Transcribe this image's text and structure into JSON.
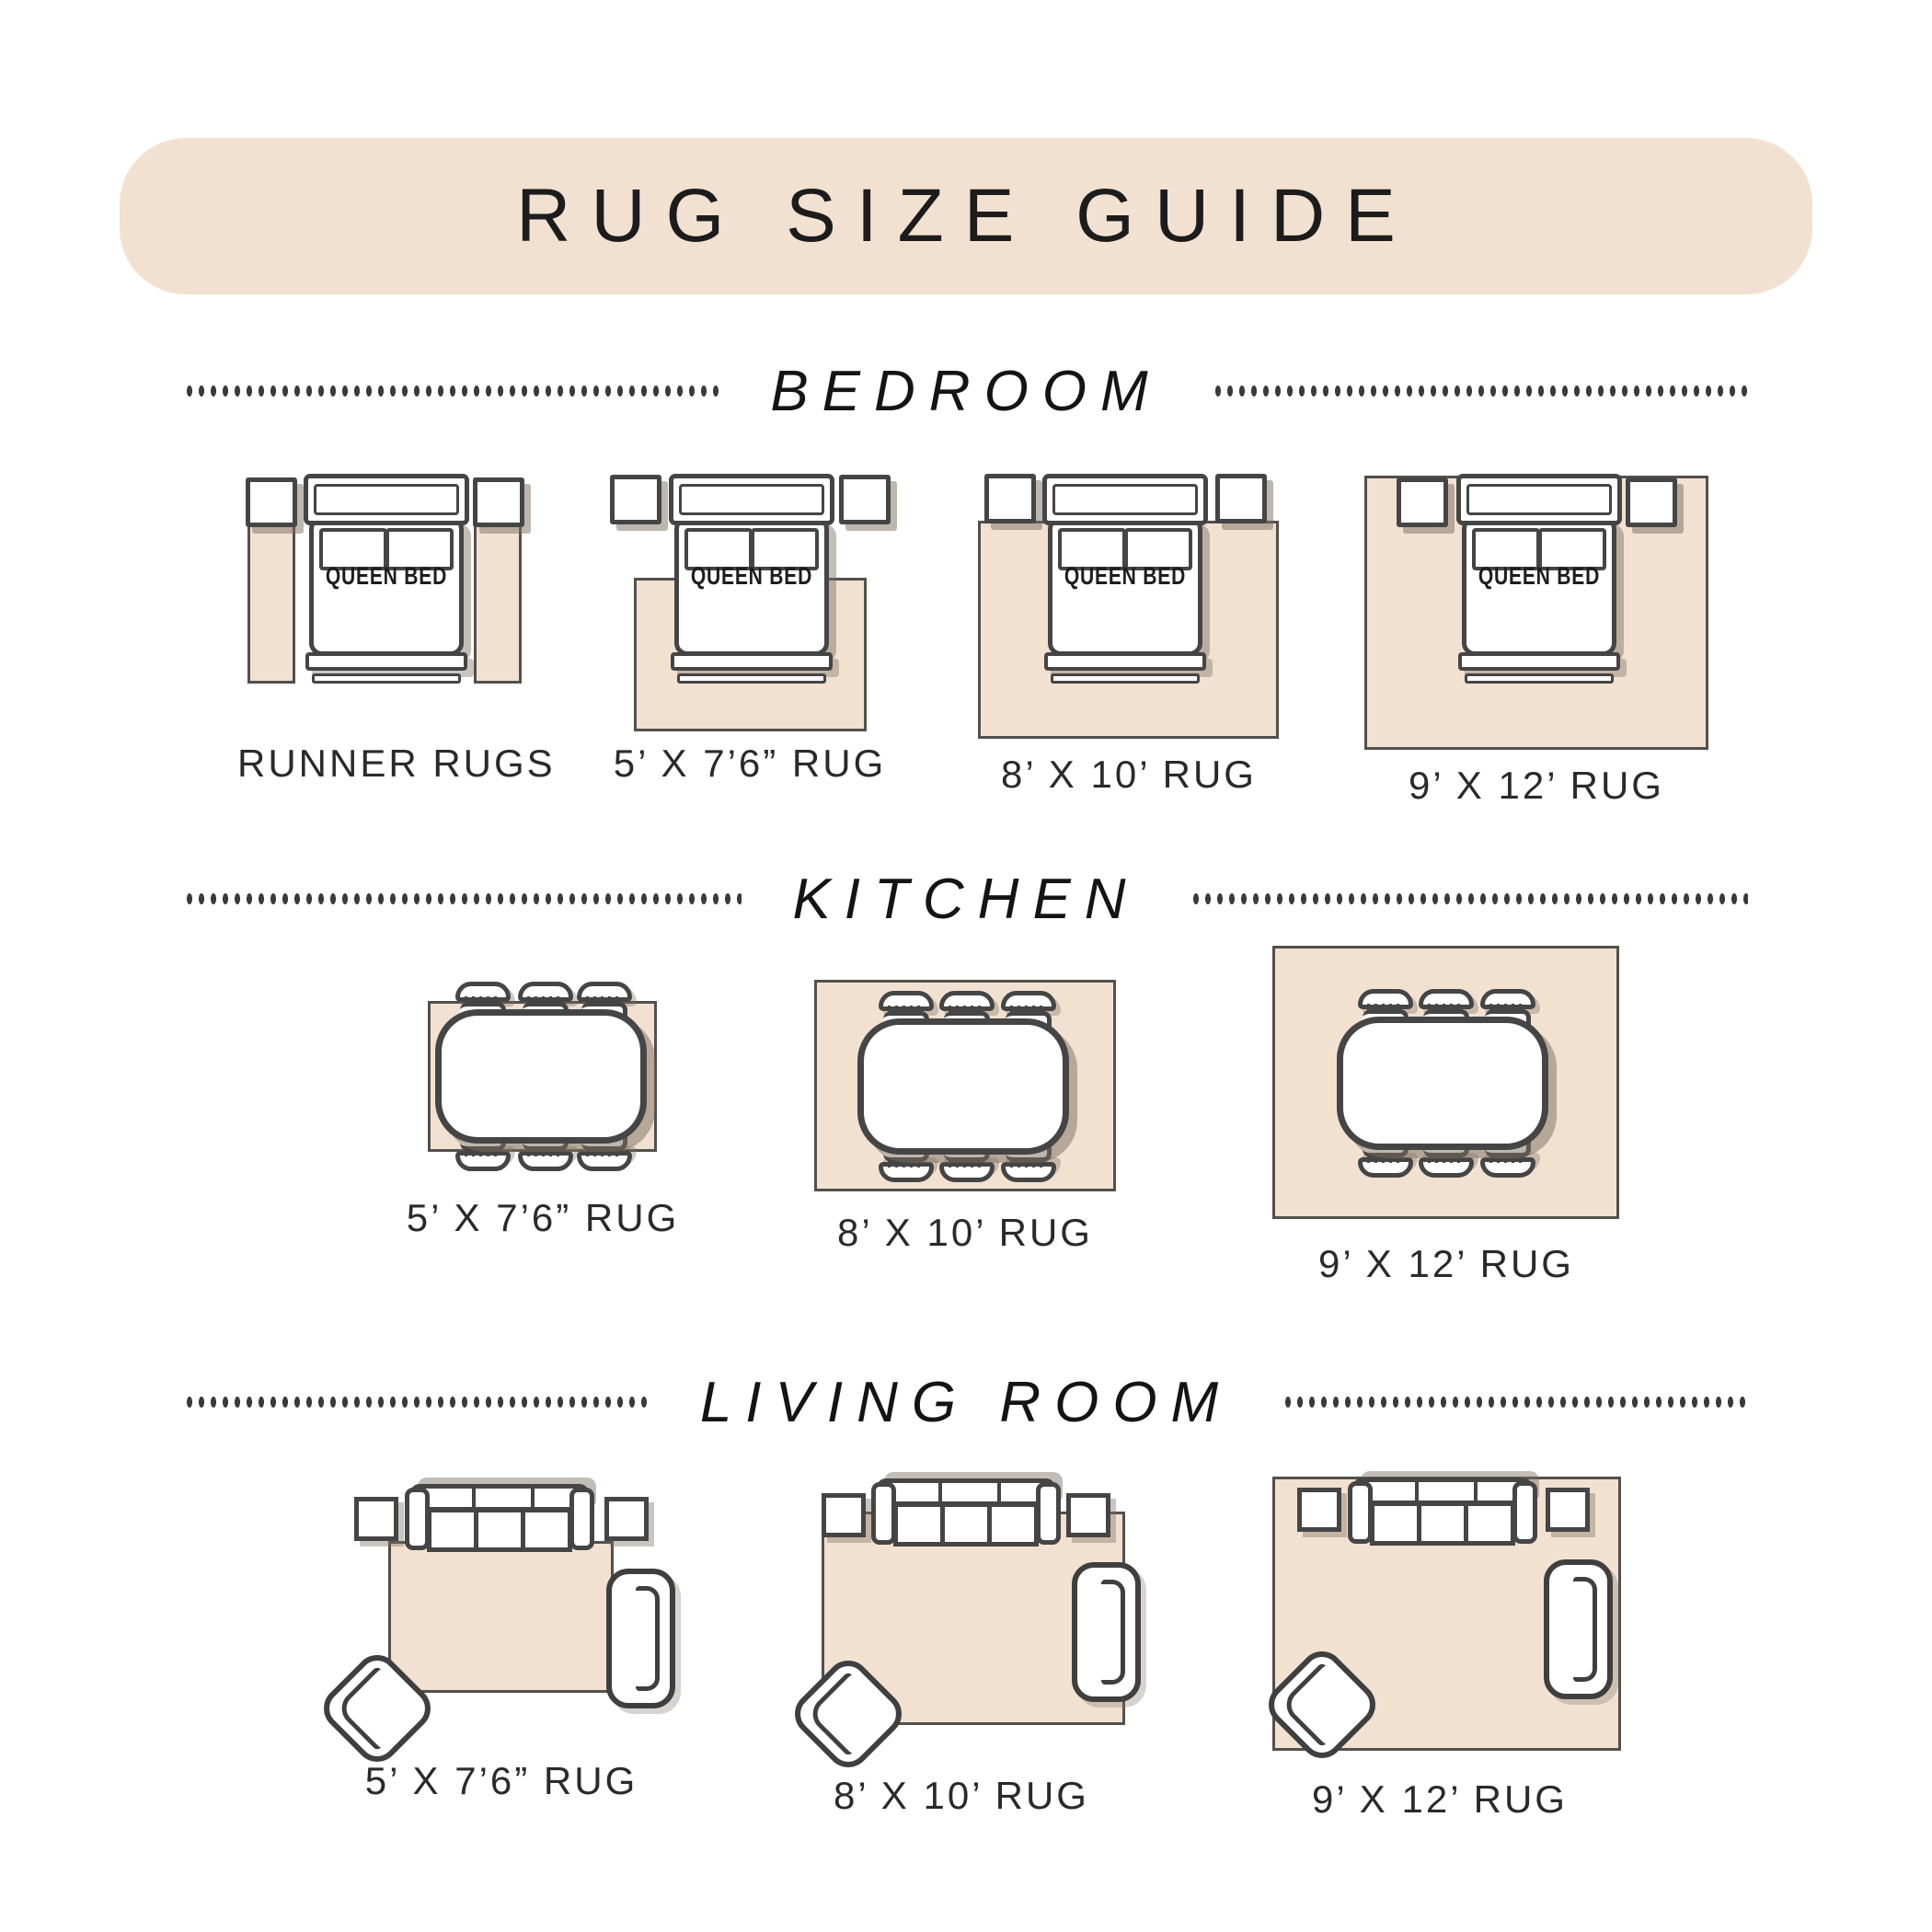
{
  "title": "RUG SIZE GUIDE",
  "bed": {
    "label": "QUEEN BED"
  },
  "sections": [
    {
      "name": "BEDROOM",
      "items": [
        {
          "label": "RUNNER RUGS"
        },
        {
          "label": "5’ X 7’6” RUG"
        },
        {
          "label": "8’ X 10’ RUG"
        },
        {
          "label": "9’ X 12’ RUG"
        }
      ]
    },
    {
      "name": "KITCHEN",
      "items": [
        {
          "label": "5’ X 7’6” RUG"
        },
        {
          "label": "8’ X 10’ RUG"
        },
        {
          "label": "9’ X 12’ RUG"
        }
      ]
    },
    {
      "name": "LIVING ROOM",
      "items": [
        {
          "label": "5’ X 7’6” RUG"
        },
        {
          "label": "8’ X 10’ RUG"
        },
        {
          "label": "9’ X 12’ RUG"
        }
      ]
    }
  ],
  "colors": {
    "accent_beige": "#f2e1d1",
    "outline_dark": "#454545",
    "text": "#1f1f1f",
    "shadow": "#7a6d60"
  }
}
